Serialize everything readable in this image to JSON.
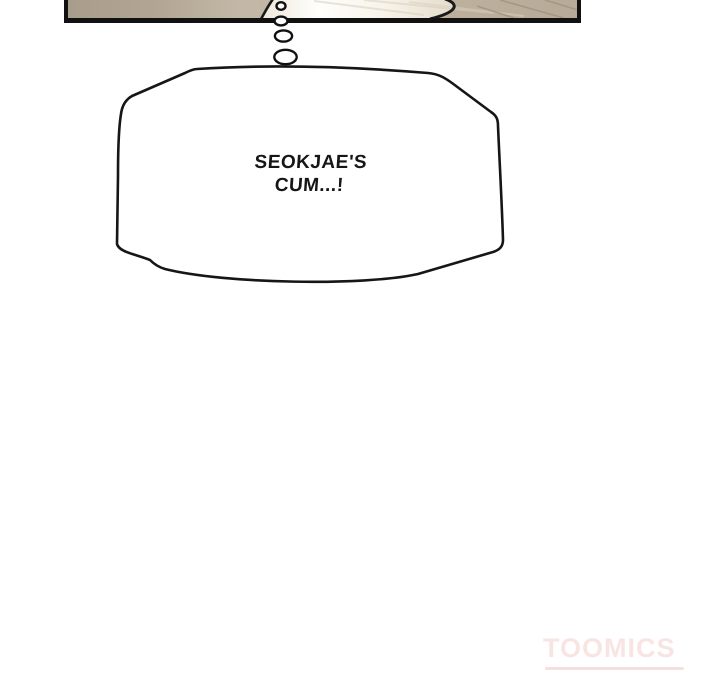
{
  "page": {
    "background_color": "#ffffff"
  },
  "panel": {
    "border_color": "#111111",
    "wall_color": "#b7aa98",
    "wall_color_dark": "#a89c8b",
    "sheet_highlight_color": "#fdfcf9"
  },
  "thought_bubble": {
    "lines": [
      "SEOKJAE'S",
      "CUM...!"
    ],
    "fill_color": "#ffffff",
    "outline_color": "#161616",
    "text_color": "#161616"
  },
  "watermark": {
    "text": "TOOMICS",
    "color": "#f8e5e3"
  }
}
